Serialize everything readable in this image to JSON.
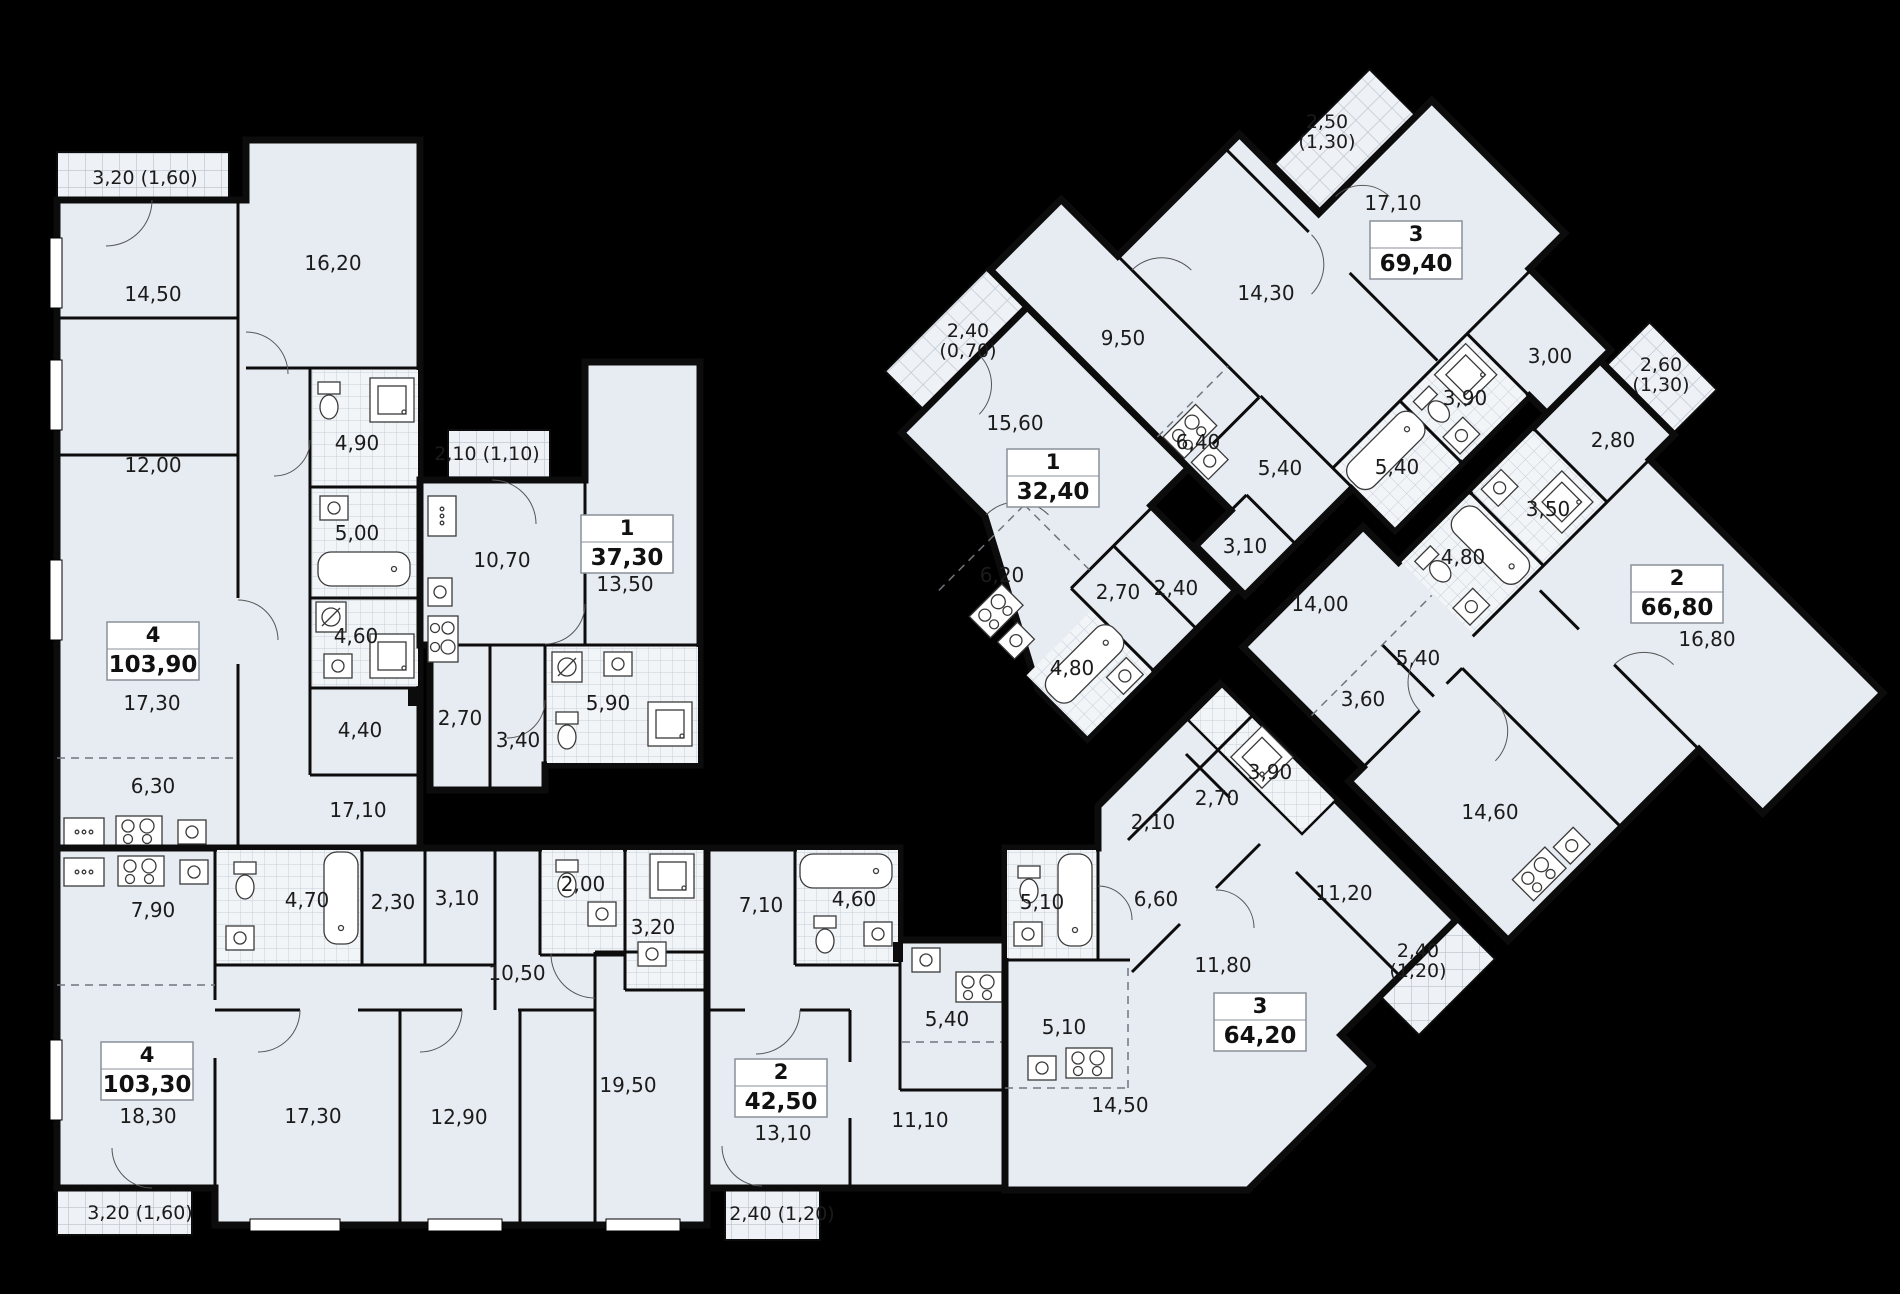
{
  "plan_title": "residential floor plan",
  "colors": {
    "background": "#000000",
    "floor": "#e7ecf2",
    "wall": "#0c0c0c",
    "tile_line": "#c7ced8",
    "balcony_line": "#b9c1cb",
    "text": "#1b1b1b",
    "badge_fill": "#ffffff",
    "badge_border": "#8a9099"
  },
  "units": [
    {
      "id": "apt-4-103-90",
      "type": "4",
      "area": "103,90",
      "badge": [
        153,
        651
      ],
      "rooms": [
        [
          "14,50",
          153,
          294
        ],
        [
          "16,20",
          333,
          263
        ],
        [
          "12,00",
          153,
          465
        ],
        [
          "4,90",
          357,
          443
        ],
        [
          "5,00",
          357,
          533
        ],
        [
          "4,60",
          356,
          636
        ],
        [
          "4,40",
          360,
          730
        ],
        [
          "17,30",
          152,
          703
        ],
        [
          "6,30",
          153,
          786
        ],
        [
          "17,10",
          358,
          810
        ]
      ],
      "balconies": [
        {
          "lines": [
            "3,20 (1,60)"
          ],
          "x": 145,
          "y": 177
        }
      ]
    },
    {
      "id": "apt-1-37-30",
      "type": "1",
      "area": "37,30",
      "badge": [
        627,
        544
      ],
      "rooms": [
        [
          "10,70",
          502,
          560
        ],
        [
          "13,50",
          625,
          584
        ],
        [
          "2,70",
          460,
          718
        ],
        [
          "3,40",
          518,
          740
        ],
        [
          "5,90",
          608,
          703
        ]
      ],
      "balconies": [
        {
          "lines": [
            "2,10 (1,10)"
          ],
          "x": 487,
          "y": 453
        }
      ]
    },
    {
      "id": "apt-1-32-40",
      "type": "1",
      "area": "32,40",
      "badge": [
        1053,
        478
      ],
      "rooms": [
        [
          "15,60",
          1015,
          423
        ],
        [
          "6,20",
          1002,
          575
        ],
        [
          "2,70",
          1118,
          592
        ],
        [
          "2,40",
          1176,
          588
        ],
        [
          "4,80",
          1072,
          668
        ]
      ],
      "balconies": [
        {
          "lines": [
            "2,40",
            "(0,70)"
          ],
          "x": 968,
          "y": 330
        }
      ]
    },
    {
      "id": "apt-3-69-40",
      "type": "3",
      "area": "69,40",
      "badge": [
        1416,
        250
      ],
      "rooms": [
        [
          "17,10",
          1393,
          203
        ],
        [
          "14,30",
          1266,
          293
        ],
        [
          "9,50",
          1123,
          338
        ],
        [
          "6,40",
          1198,
          442
        ],
        [
          "5,40",
          1280,
          468
        ],
        [
          "3,10",
          1245,
          546
        ],
        [
          "5,40",
          1397,
          467
        ],
        [
          "3,90",
          1465,
          398
        ],
        [
          "3,00",
          1550,
          356
        ]
      ],
      "balconies": [
        {
          "lines": [
            "2,50",
            "(1,30)"
          ],
          "x": 1327,
          "y": 121
        }
      ]
    },
    {
      "id": "apt-2-66-80",
      "type": "2",
      "area": "66,80",
      "badge": [
        1677,
        594
      ],
      "rooms": [
        [
          "14,00",
          1320,
          604
        ],
        [
          "2,80",
          1613,
          440
        ],
        [
          "3,50",
          1548,
          509
        ],
        [
          "4,80",
          1463,
          557
        ],
        [
          "5,40",
          1418,
          658
        ],
        [
          "3,60",
          1363,
          699
        ],
        [
          "16,80",
          1707,
          639
        ],
        [
          "14,60",
          1490,
          812
        ]
      ],
      "balconies": [
        {
          "lines": [
            "2,60",
            "(1,30)"
          ],
          "x": 1661,
          "y": 364
        }
      ]
    },
    {
      "id": "apt-4-103-30",
      "type": "4",
      "area": "103,30",
      "badge": [
        147,
        1071
      ],
      "rooms": [
        [
          "7,90",
          153,
          910
        ],
        [
          "4,70",
          307,
          900
        ],
        [
          "2,30",
          393,
          902
        ],
        [
          "3,10",
          457,
          898
        ],
        [
          "2,00",
          583,
          884
        ],
        [
          "3,20",
          653,
          927
        ],
        [
          "10,50",
          517,
          973
        ],
        [
          "18,30",
          148,
          1116
        ],
        [
          "17,30",
          313,
          1116
        ],
        [
          "12,90",
          459,
          1117
        ],
        [
          "19,50",
          628,
          1085
        ]
      ],
      "balconies": [
        {
          "lines": [
            "3,20 (1,60)"
          ],
          "x": 140,
          "y": 1212
        }
      ]
    },
    {
      "id": "apt-2-42-50",
      "type": "2",
      "area": "42,50",
      "badge": [
        781,
        1088
      ],
      "rooms": [
        [
          "7,10",
          761,
          905
        ],
        [
          "4,60",
          854,
          899
        ],
        [
          "5,40",
          947,
          1019
        ],
        [
          "13,10",
          783,
          1133
        ],
        [
          "11,10",
          920,
          1120
        ]
      ],
      "balconies": [
        {
          "lines": [
            "2,40 (1,20)"
          ],
          "x": 782,
          "y": 1213
        }
      ]
    },
    {
      "id": "apt-3-64-20",
      "type": "3",
      "area": "64,20",
      "badge": [
        1260,
        1022
      ],
      "rooms": [
        [
          "5,10",
          1042,
          902
        ],
        [
          "6,60",
          1156,
          899
        ],
        [
          "2,10",
          1153,
          822
        ],
        [
          "2,70",
          1217,
          798
        ],
        [
          "3,90",
          1270,
          772
        ],
        [
          "11,20",
          1344,
          893
        ],
        [
          "11,80",
          1223,
          965
        ],
        [
          "5,10",
          1064,
          1027
        ],
        [
          "14,50",
          1120,
          1105
        ]
      ],
      "balconies": [
        {
          "lines": [
            "2,40",
            "(1,20)"
          ],
          "x": 1418,
          "y": 950
        }
      ]
    }
  ]
}
